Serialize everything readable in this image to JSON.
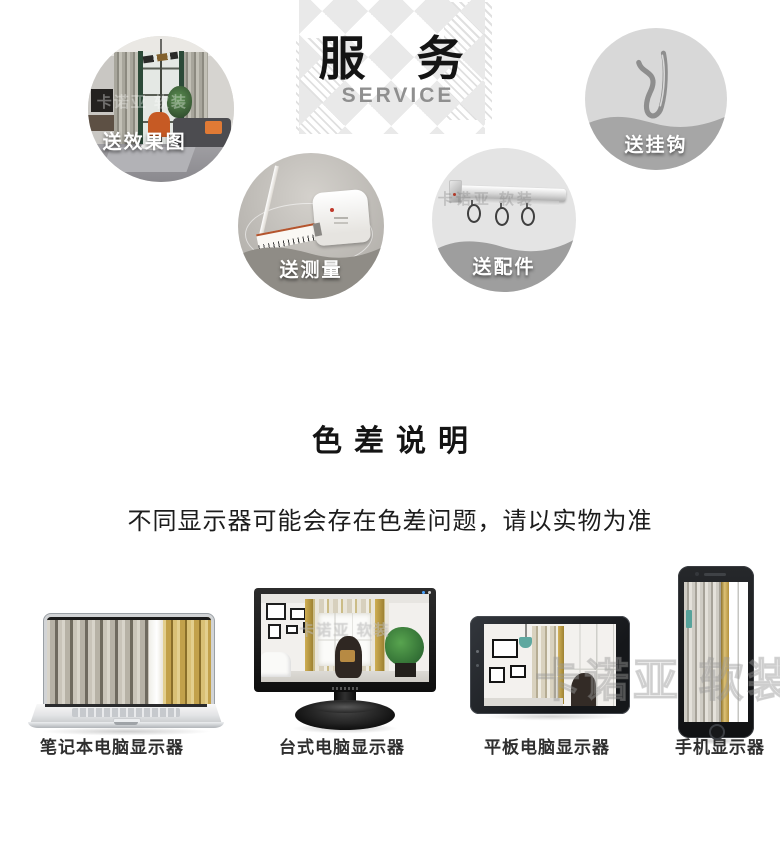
{
  "service": {
    "title": "服　务",
    "subtitle": "SERVICE",
    "items": [
      {
        "id": "effect-render",
        "label": "送效果图"
      },
      {
        "id": "hooks",
        "label": "送挂钩"
      },
      {
        "id": "measure",
        "label": "送测量"
      },
      {
        "id": "accessories",
        "label": "送配件"
      }
    ]
  },
  "color_note": {
    "title": "色差说明",
    "body": "不同显示器可能会存在色差问题，请以实物为准"
  },
  "devices": [
    {
      "id": "laptop",
      "label": "笔记本电脑显示器"
    },
    {
      "id": "desktop",
      "label": "台式电脑显示器"
    },
    {
      "id": "tablet",
      "label": "平板电脑显示器"
    },
    {
      "id": "phone",
      "label": "手机显示器"
    }
  ],
  "watermark": {
    "text": "卡诺亚 软装"
  },
  "colors": {
    "heading_text": "#141414",
    "subtitle_text": "#8f8f8f",
    "diamond_pattern": "#e9e9e9",
    "badge_text": "#ffffff",
    "wave_gray": "#a6a6a6",
    "note_text": "#1c1c1c",
    "device_label_text": "#2f2f2f",
    "curtain_gold": "#c2a14b",
    "curtain_gray": "#b7b2a6"
  }
}
